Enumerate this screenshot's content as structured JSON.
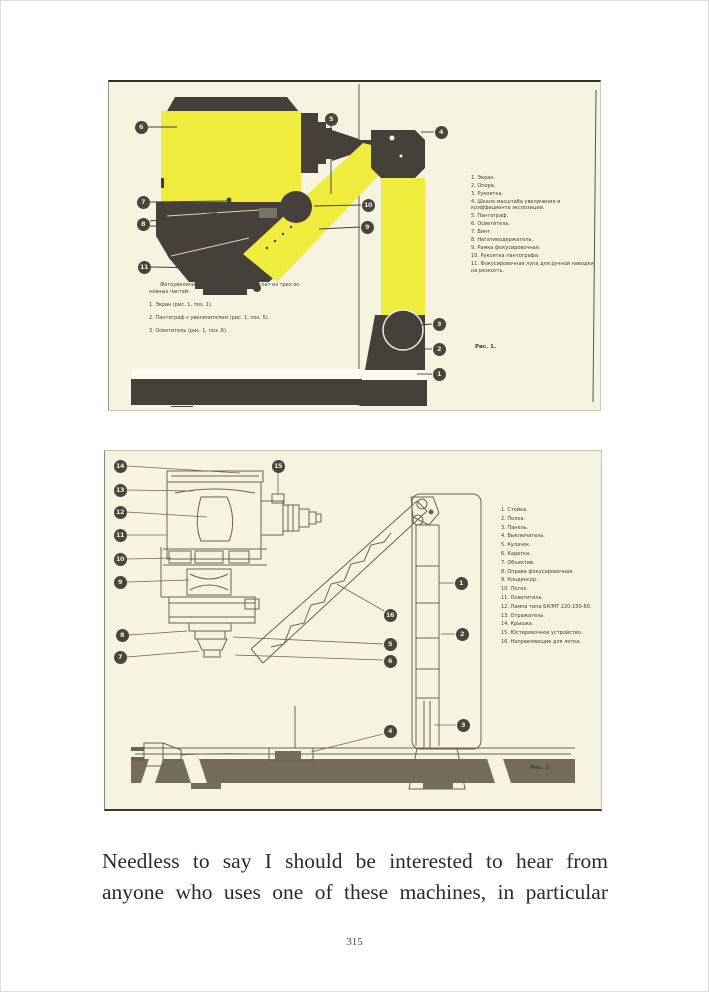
{
  "colors": {
    "scan_bg": "#f6f3e1",
    "highlight_yellow": "#f0ec3d",
    "ink_dark": "#45413a",
    "drawing_ink": "#6b6456",
    "callout_bg": "#4a453c",
    "callout_text": "#ece8d4"
  },
  "figure1": {
    "caption": "Рис. 1.",
    "intro": {
      "line1": "Фотоувеличитель конструктивно состоит из трех ос-",
      "line2": "новных частей:",
      "items": [
        "1. Экран (рис. 1, поз. 1).",
        "2. Пантограф с увеличителем (рис. 1, поз. 5).",
        "3. Осветитель (рис. 1, поз. 6)."
      ]
    },
    "parts": [
      "1. Экран.",
      "2. Опора.",
      "3. Рукоятка.",
      "4. Шкала масштаба увеличения и коэффициента экспозиции.",
      "5. Пантограф.",
      "6. Осветитель.",
      "7. Винт.",
      "8. Негативодержатель.",
      "9. Рамка фокусировочная.",
      "10. Рукоятка пантографа.",
      "11. Фокусировочная лупа для ручной наводки на резкость."
    ],
    "callouts": [
      "6",
      "7",
      "8",
      "11",
      "5",
      "4",
      "10",
      "9",
      "3",
      "2",
      "1"
    ]
  },
  "figure2": {
    "caption": "Рис. 2",
    "parts": [
      "1. Стойка.",
      "2. Полка.",
      "3. Панель.",
      "4. Выключатель.",
      "5. Кулачок.",
      "6. Каретка.",
      "7. Объектив.",
      "8. Оправа фокусировочная.",
      "9. Конденсор.",
      "10. Лоток.",
      "11. Осветитель.",
      "12. Лампа типа БК/МТ 220-230-60.",
      "13. Отражатель.",
      "14. Крышка.",
      "15. Юстировочное устройство.",
      "16. Направляющие для лотка."
    ],
    "callouts": [
      "14",
      "13",
      "12",
      "11",
      "10",
      "9",
      "8",
      "7",
      "15",
      "16",
      "5",
      "6",
      "1",
      "2",
      "3",
      "4"
    ]
  },
  "body_text": {
    "line1": "Needless to say I should be interested to hear from",
    "line2": "anyone who uses one of these machines, in particular"
  },
  "page_number": "315"
}
